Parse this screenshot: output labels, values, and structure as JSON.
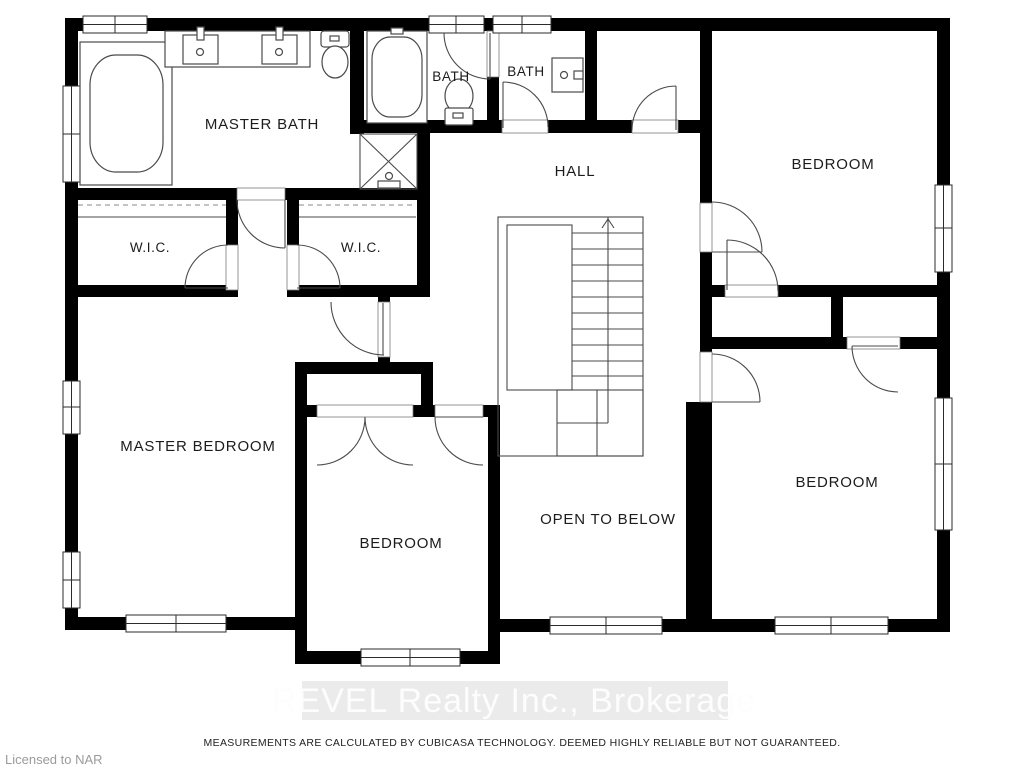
{
  "floorplan": {
    "rooms": [
      {
        "name": "master-bath",
        "label": "MASTER BATH"
      },
      {
        "name": "bath-1",
        "label": "BATH"
      },
      {
        "name": "bath-2",
        "label": "BATH"
      },
      {
        "name": "hall",
        "label": "HALL"
      },
      {
        "name": "bedroom-top-right",
        "label": "BEDROOM"
      },
      {
        "name": "wic-left",
        "label": "W.I.C."
      },
      {
        "name": "wic-right",
        "label": "W.I.C."
      },
      {
        "name": "master-bedroom",
        "label": "MASTER BEDROOM"
      },
      {
        "name": "bedroom-middle",
        "label": "BEDROOM"
      },
      {
        "name": "open-to-below",
        "label": "OPEN TO BELOW"
      },
      {
        "name": "bedroom-bottom-right",
        "label": "BEDROOM"
      }
    ],
    "stairs_direction": "up",
    "fixtures": [
      "bathtub",
      "double-vanity-sinks",
      "toilet",
      "shower",
      "bathtub",
      "toilet",
      "sink"
    ],
    "wall_color": "#000000",
    "line_color": "#4a4a4a"
  },
  "watermark": {
    "text": "REVEL Realty Inc., Brokerage"
  },
  "footer": {
    "disclaimer": "MEASUREMENTS ARE CALCULATED BY CUBICASA TECHNOLOGY. DEEMED HIGHLY RELIABLE BUT NOT GUARANTEED.",
    "license": "Licensed to NAR"
  }
}
